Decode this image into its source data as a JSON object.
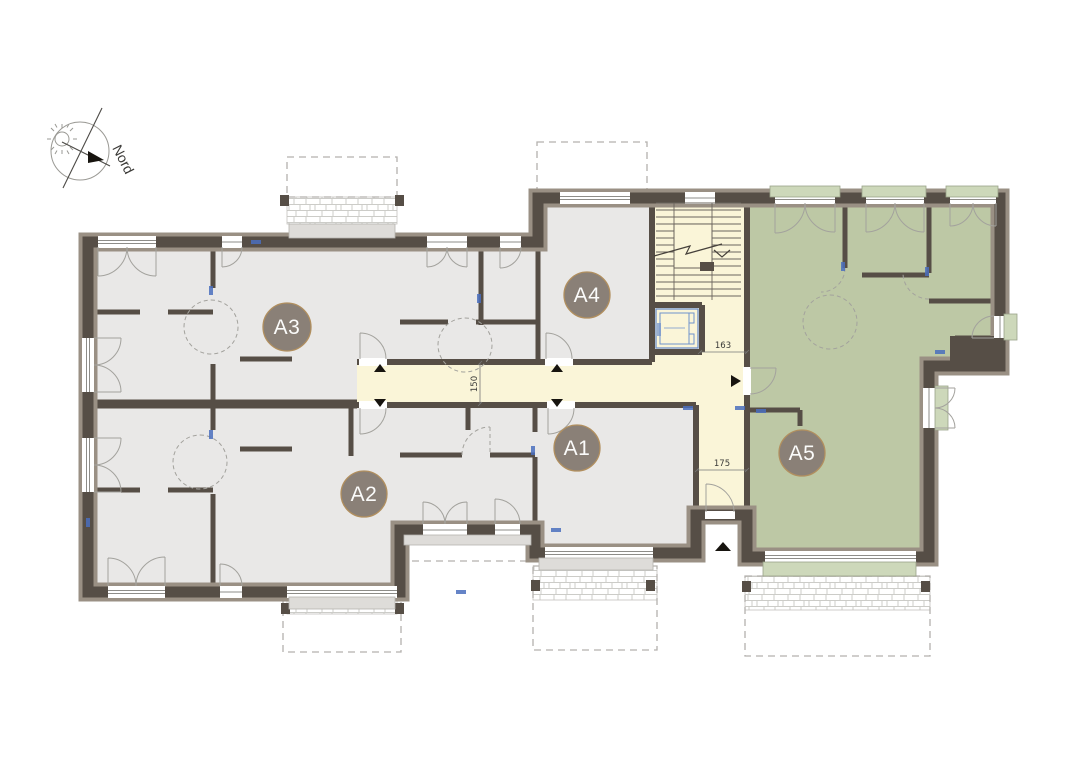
{
  "plan": {
    "compass": {
      "label": "Nord",
      "icons": [
        "sun-icon",
        "north-needle-icon"
      ]
    },
    "apartments": [
      {
        "id": "a1",
        "label": "A1",
        "floor_color_key": "floor"
      },
      {
        "id": "a2",
        "label": "A2",
        "floor_color_key": "floor"
      },
      {
        "id": "a3",
        "label": "A3",
        "floor_color_key": "floor"
      },
      {
        "id": "a4",
        "label": "A4",
        "floor_color_key": "floor"
      },
      {
        "id": "a5",
        "label": "A5",
        "floor_color_key": "apartment_a5"
      }
    ],
    "circulation": [
      "corridor",
      "stairwell",
      "elevator"
    ],
    "dimensions": [
      {
        "value": "163",
        "location": "stair-landing-width"
      },
      {
        "value": "150",
        "location": "corridor-width"
      },
      {
        "value": "175",
        "location": "entrance-hall-width"
      }
    ]
  },
  "colors": {
    "wall": "#564e46",
    "wall_outer": "#9a9084",
    "floor": "#e9e8e7",
    "corridor": "#faf5d8",
    "apartment_a5": "#bdc8a5",
    "sill_green": "#cdd8ba",
    "sill_gray": "#dedcd9",
    "elevator_blue": "#6f92cc",
    "window_mark_blue": "#4a6fbd",
    "label_bg": "#8a8077",
    "label_ring": "#b18f5f",
    "dash": "#b3b1ad",
    "arc": "#a3a29d",
    "text": "#3a3a38"
  }
}
